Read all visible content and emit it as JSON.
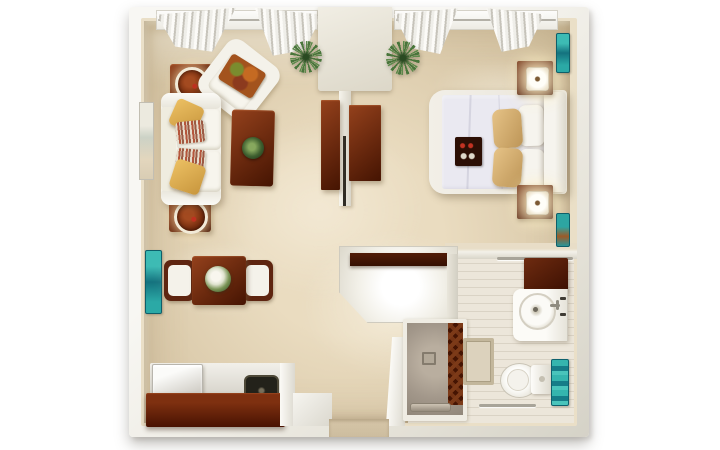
{
  "scene": {
    "type": "3d-floorplan-top-view",
    "description": "Studio apartment 3D floor plan seen from directly above",
    "rooms": [
      {
        "name": "living-area",
        "furniture": [
          "sofa-with-pillows",
          "armchair",
          "coffee-table",
          "side-table-with-lamp-tray",
          "side-table-with-lamp-tray",
          "wall-art"
        ]
      },
      {
        "name": "sleeping-area",
        "furniture": [
          "bed",
          "headboard",
          "nightstand-with-lamp",
          "nightstand-with-lamp",
          "wall-art",
          "wall-art"
        ]
      },
      {
        "name": "dining-area",
        "furniture": [
          "dining-table",
          "dining-chair",
          "dining-chair",
          "wall-art-teal"
        ]
      },
      {
        "name": "kitchenette",
        "furniture": [
          "counter",
          "appliance",
          "sink"
        ]
      },
      {
        "name": "entry",
        "furniture": [
          "console-counter-with-shelf",
          "closet-wardrobe",
          "closet-wardrobe"
        ]
      },
      {
        "name": "bathroom",
        "furniture": [
          "vanity-with-round-sink",
          "storage-cabinet",
          "toilet",
          "walk-in-shower",
          "bath-mat",
          "towel-bar",
          "towel-bar"
        ]
      }
    ],
    "decor": [
      "window-curtains",
      "window-curtains",
      "potted-plant",
      "potted-plant",
      "teal-towels",
      "table-centerpiece",
      "coffee-table-plant"
    ]
  },
  "palette": {
    "page-bg": "#ffffff",
    "wall-outer-light": "#f8f7f3",
    "wall-outer-dark": "#d5d2c7",
    "wall-face": "#eadfc7",
    "carpet": "#d8c7a7",
    "carpet-light": "#eadcc0",
    "wood-dark": "#451402",
    "wood-light": "#94411c",
    "fabric-white": "#f4f2ea",
    "gold": "#c8963d",
    "stripe-red": "#b5563c",
    "teal": "#2ba9a6",
    "teal-dark": "#14727e",
    "duvet": "#eae9f1",
    "tan": "#bd9557",
    "bath-floor": "#ece6da",
    "shower-floor": "#a2978a",
    "mosaic-dark": "#451402",
    "mosaic-mid": "#7c3a18",
    "green": "#49763b",
    "green-dark": "#2a4a22",
    "metal": "#a8a499"
  }
}
